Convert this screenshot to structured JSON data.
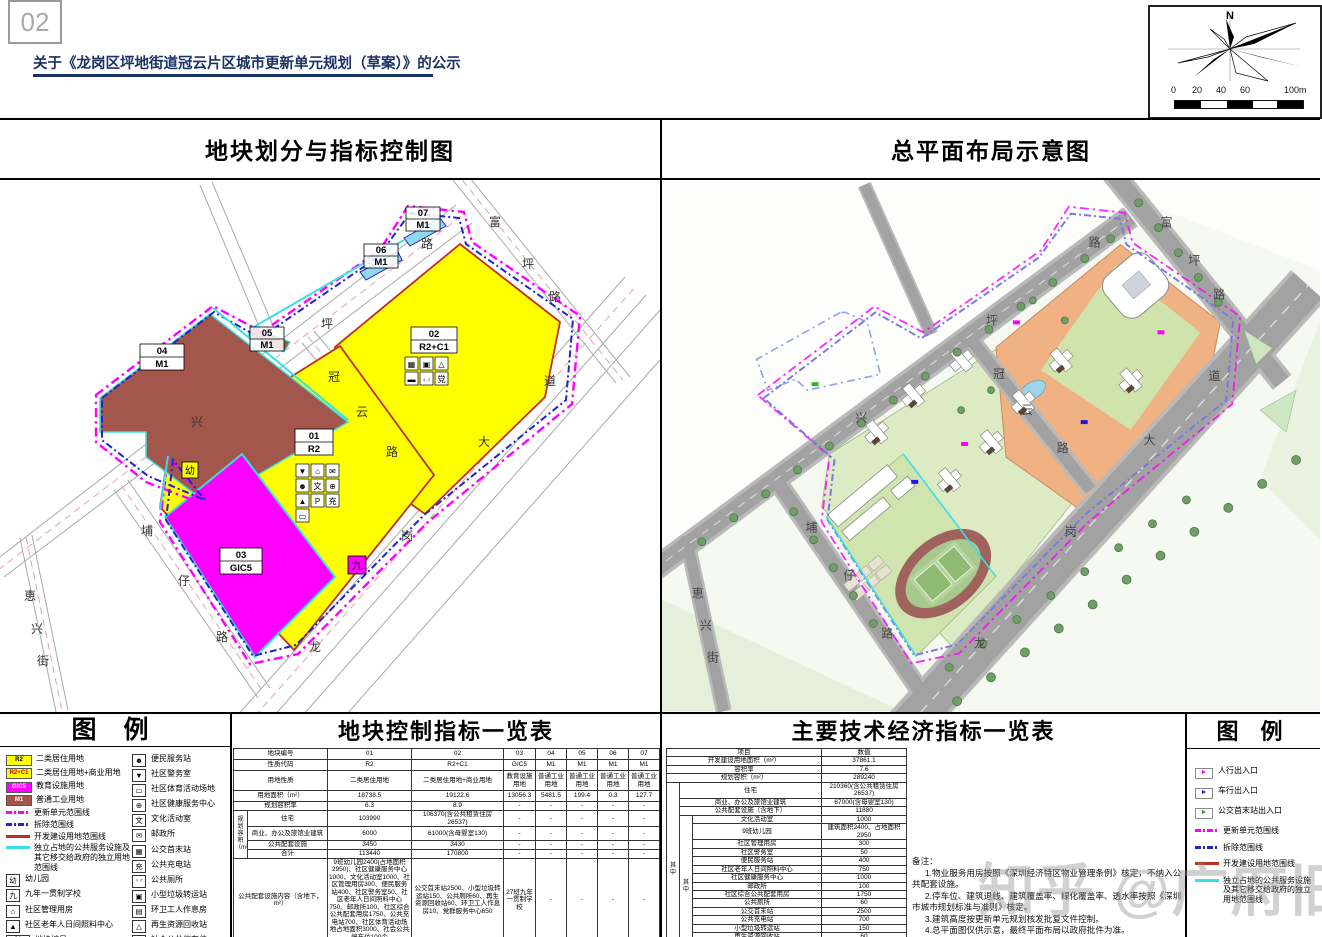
{
  "header": {
    "page_number": "02",
    "title": "关于《龙岗区坪地街道冠云片区城市更新单元规划（草案）》的公示"
  },
  "compass": {
    "north": "N",
    "scale": [
      "0",
      "20",
      "40",
      "60",
      "100m"
    ]
  },
  "watermark": "知乎 @广府旧改",
  "left_map": {
    "title": "地块划分与指标控制图",
    "parcels": [
      {
        "id": "01",
        "code": "R2"
      },
      {
        "id": "02",
        "code": "R2+C1"
      },
      {
        "id": "03",
        "code": "GIC5"
      },
      {
        "id": "04",
        "code": "M1"
      },
      {
        "id": "05",
        "code": "M1"
      },
      {
        "id": "06",
        "code": "M1"
      },
      {
        "id": "07",
        "code": "M1"
      }
    ],
    "marks": {
      "kindergarten": "幼",
      "school9": "九"
    },
    "p01_icons": [
      "▼",
      "⌂",
      "✉",
      "☻",
      "文",
      "⊕",
      "▲",
      "P",
      "充",
      "▭"
    ],
    "p02_icons": [
      "▦",
      "▣",
      "△",
      "▬",
      "♀♂",
      "党"
    ],
    "roads": {
      "fuping": "富坪路",
      "xingping": "兴坪路",
      "guanyun": "冠云路",
      "longgang": "龙岗大道",
      "puzai": "埔仔路",
      "huixing": "恵兴街"
    }
  },
  "right_map": {
    "title": "总平面布局示意图",
    "roads": {
      "fuping": "富坪路",
      "xingping": "兴坪路",
      "guanyun": "冠云路",
      "longgang": "龙岗大道",
      "puzai": "埔仔路",
      "huixing": "恵兴街"
    }
  },
  "legend_left": {
    "title": "图  例",
    "col1": [
      {
        "code": "R2",
        "label": "二类居住用地"
      },
      {
        "code": "R2+C1",
        "label": "二类居住用地+商业用地"
      },
      {
        "code": "GIC5",
        "label": "教育设施用地"
      },
      {
        "code": "M1",
        "label": "普通工业用地"
      },
      {
        "label": "更新单元范围线"
      },
      {
        "label": "拆除范围线"
      },
      {
        "label": "开发建设用地范围线"
      },
      {
        "label": "独立占地的公共服务设施及其它移交给政府的独立用地范围线"
      },
      {
        "glyph": "幼",
        "label": "幼儿园"
      },
      {
        "glyph": "九",
        "label": "九年一贯制学校"
      },
      {
        "glyph": "⌂",
        "label": "社区管理用房"
      },
      {
        "glyph": "▲",
        "label": "社区老年人日间照料中心"
      },
      {
        "top": "01",
        "bot": "R2",
        "label": "地块编号",
        "label2": "用地性质"
      }
    ],
    "col2": [
      {
        "glyph": "☻",
        "label": "便民服务站"
      },
      {
        "glyph": "▼",
        "label": "社区警务室"
      },
      {
        "glyph": "▭",
        "label": "社区体育活动场地"
      },
      {
        "glyph": "⊕",
        "label": "社区健康服务中心"
      },
      {
        "glyph": "文",
        "label": "文化活动室"
      },
      {
        "glyph": "✉",
        "label": "邮政所"
      },
      {
        "glyph": "▦",
        "label": "公交首末站"
      },
      {
        "glyph": "充",
        "label": "公共充电站"
      },
      {
        "glyph": "♀♂",
        "label": "公共厕所"
      },
      {
        "glyph": "▣",
        "label": "小型垃圾转运站"
      },
      {
        "glyph": "▤",
        "label": "环卫工人作息房"
      },
      {
        "glyph": "△",
        "label": "再生资源回收站"
      },
      {
        "glyph": "P",
        "label": "社会公共停车位"
      },
      {
        "glyph": "党",
        "label": "党群服务中心"
      }
    ]
  },
  "mid_table": {
    "title": "地块控制指标一览表",
    "labels": {
      "plot_no": "地块编号",
      "code": "性质代码",
      "land_use": "用地性质",
      "land_area": "用地面积（m²）",
      "far": "规划容积率",
      "capacity_group": "规划容积（m²）",
      "residential": "住宅",
      "commercial": "商业、办公及旅馆业建筑",
      "public_facilities": "公共配套设施",
      "total": "合计",
      "facility_content": "公共配套设施内容（含地下，m²）",
      "runoff": "年径流总量控制率（%）",
      "remark": "备注"
    },
    "plot_no": [
      "01",
      "02",
      "03",
      "04",
      "05",
      "06",
      "07"
    ],
    "code": [
      "R2",
      "R2+C1",
      "GIC5",
      "M1",
      "M1",
      "M1",
      "M1"
    ],
    "land_use": [
      "二类居住用地",
      "二类居住用地+商业用地",
      "教育设施用地",
      "普通工业用地",
      "普通工业用地",
      "普通工业用地",
      "普通工业用地"
    ],
    "land_area": [
      "18738.5",
      "19122.6",
      "13056.3",
      "5481.5",
      "199.4",
      "0.3",
      "127.7"
    ],
    "far": [
      "6.3",
      "8.9",
      "-",
      "-",
      "-",
      "-",
      "-"
    ],
    "residential": [
      "103990",
      "106370(含公共租赁住房26537)",
      "-",
      "-",
      "-",
      "-",
      "-"
    ],
    "commercial": [
      "6000",
      "61000(含母婴室130)",
      "-",
      "-",
      "-",
      "-",
      "-"
    ],
    "public_facilities": [
      "3450",
      "3430",
      "-",
      "-",
      "-",
      "-",
      "-"
    ],
    "total": [
      "113440",
      "170800",
      "-",
      "-",
      "-",
      "-",
      "-"
    ],
    "facility_content": [
      "9班幼儿园2400(占地面积2950)、社区健康服务中心1000、文化活动室1000、社区管理用房300、便民服务站400、社区警务室50、社区老年人日间照料中心750、邮政所100、社区综合公共配套用房1750、公共充电站700、社区体育活动场地占地面积3000、社会公共停车位100个",
      "公交首末站2500、小型垃圾转运站150、公共厕所60、再生资源回收站60、环卫工人作息房10、党群服务中心650",
      "27班九年一贯制学校",
      "-",
      "-",
      "-",
      "-"
    ],
    "runoff": [
      "66",
      "66",
      "67",
      "65",
      "-",
      "-",
      "-"
    ],
    "remark": [
      "拆除重建",
      "拆除重建",
      "拆除重建",
      "拆除重建",
      "拆除重建",
      "拆除重建",
      "拆除重建"
    ]
  },
  "right_table": {
    "title": "主要技术经济指标一览表",
    "header": {
      "item": "项目",
      "value": "数值"
    },
    "qizhong": "其中",
    "rows_top": [
      {
        "label": "开发建设用地面积（m²）",
        "value": "37861.1"
      },
      {
        "label": "容积率",
        "value": "7.6"
      },
      {
        "label": "规划容积（m²）",
        "value": "289240"
      }
    ],
    "rows_l1": [
      {
        "label": "住宅",
        "value": "210360(含公共租赁住房26537)"
      },
      {
        "label": "商业、办公及旅馆业建筑",
        "value": "67000(含母婴室130)"
      },
      {
        "label": "公共配套设施（含地下）",
        "value": "11880"
      }
    ],
    "rows_l2": [
      {
        "label": "文化活动室",
        "value": "1000"
      },
      {
        "label": "9班幼儿园",
        "value": "建筑面积2400、占地面积2950"
      },
      {
        "label": "社区管理用房",
        "value": "300"
      },
      {
        "label": "社区警务室",
        "value": "50"
      },
      {
        "label": "便民服务站",
        "value": "400"
      },
      {
        "label": "社区老年人日间照料中心",
        "value": "750"
      },
      {
        "label": "社区健康服务中心",
        "value": "1000"
      },
      {
        "label": "邮政所",
        "value": "100"
      },
      {
        "label": "社区综合公共配套用房",
        "value": "1750"
      },
      {
        "label": "公共厕所",
        "value": "60"
      },
      {
        "label": "公交首末站",
        "value": "2500"
      },
      {
        "label": "公共充电站",
        "value": "700"
      },
      {
        "label": "小型垃圾转运站",
        "value": "150"
      },
      {
        "label": "再生资源回收站",
        "value": "60"
      },
      {
        "label": "环卫工人作息房",
        "value": "10"
      },
      {
        "label": "党群服务中心",
        "value": "650"
      }
    ],
    "rows_bottom": [
      {
        "label": "社区体育活动场地",
        "value": "占地面积3000"
      },
      {
        "label": "社会公共停车位",
        "value": "100个"
      }
    ],
    "notes_title": "备注：",
    "notes": [
      "1.物业服务用房按照《深圳经济特区物业管理条例》核定，不纳入公共配套设施。",
      "2.停车位、建筑退线、建筑覆盖率、绿化覆盖率、透水率按照《深圳市城市规划标准与准则》核定。",
      "3.建筑高度按更新单元规划核发批复文件控制。",
      "4.总平面图仅供示意，最终平面布局以政府批件为准。"
    ]
  },
  "legend_right": {
    "title": "图  例",
    "items": [
      {
        "type": "chip-magenta",
        "label": "人行出入口"
      },
      {
        "type": "chip-blue",
        "label": "车行出入口"
      },
      {
        "type": "chip-green",
        "label": "公交首末站出入口"
      },
      {
        "type": "line-magenta",
        "label": "更新单元范围线"
      },
      {
        "type": "line-blue",
        "label": "拆除范围线"
      },
      {
        "type": "line-red",
        "label": "开发建设用地范围线"
      },
      {
        "type": "line-cyan",
        "label": "独立占地的公共服务设施及其它移交给政府的独立用地范围线"
      }
    ]
  }
}
